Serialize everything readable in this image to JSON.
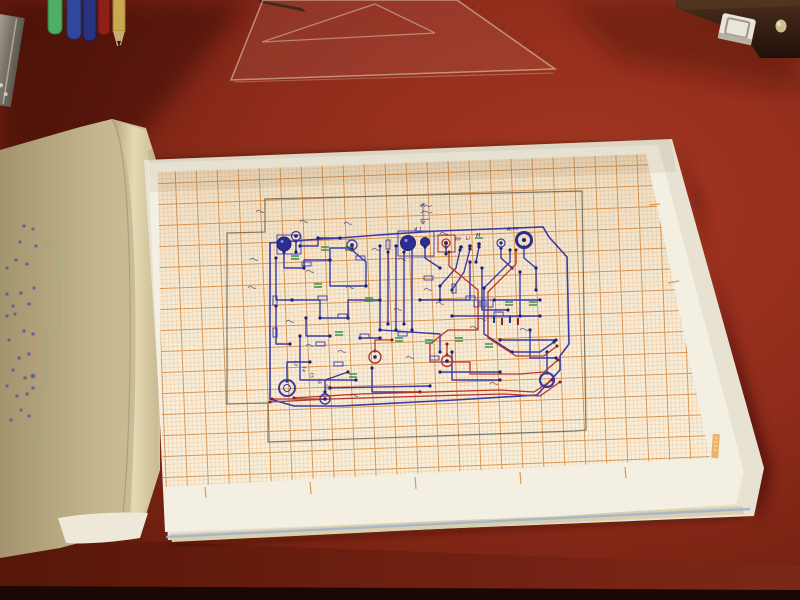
{
  "scene": {
    "description": "Photograph of an open sketchbook on a dark red desk showing a hand-drawn printed-circuit layout in blue, red and green ink on orange millimeter graph paper, surrounded by a transparent set square, felt-tip pens, a pencil, a metal ruler and a stapler",
    "colors": {
      "desk": "#8e2b1b",
      "desk_shadow": "#4a130b",
      "desk_front": "#6e1f10",
      "graph_paper": "#f8efdb",
      "grid_minor": "#e2a063",
      "grid_major": "#d4863c",
      "page_white": "#f3efe2",
      "page_tan": "#c4b58d",
      "ink_blue": "#3a3aa5",
      "ink_navy": "#1e2173",
      "ink_red": "#b5352a",
      "ink_green": "#3f8f4f",
      "pencil_frame": "#6b6355"
    }
  },
  "circuit": {
    "labels": {
      "pot_value": "4.1",
      "terminal_re": "Re",
      "terminal_li": "Li",
      "terminal_m": "M",
      "battery": "Accu"
    },
    "pins": [
      "13",
      "14",
      "15",
      "16",
      "20"
    ]
  }
}
